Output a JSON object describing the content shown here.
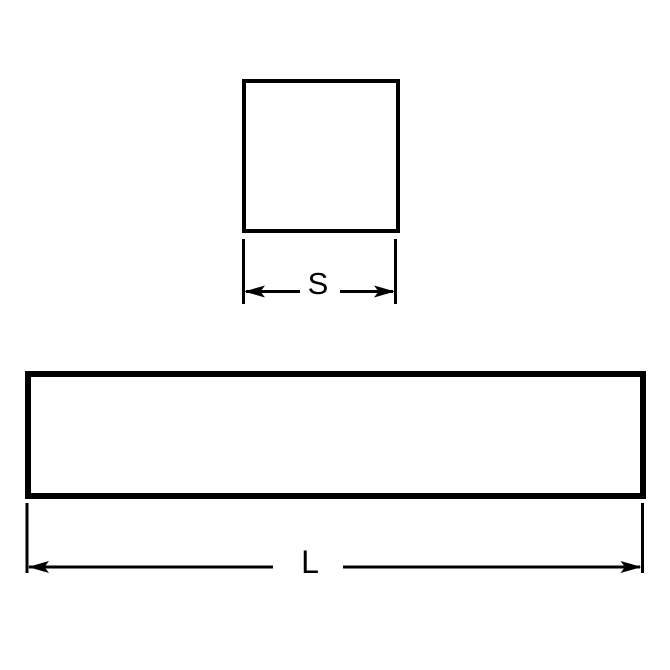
{
  "page": {
    "background_color": "#ffffff"
  },
  "diagram": {
    "line_color": "#000000",
    "labels": {
      "s": "S",
      "l": "L"
    }
  }
}
